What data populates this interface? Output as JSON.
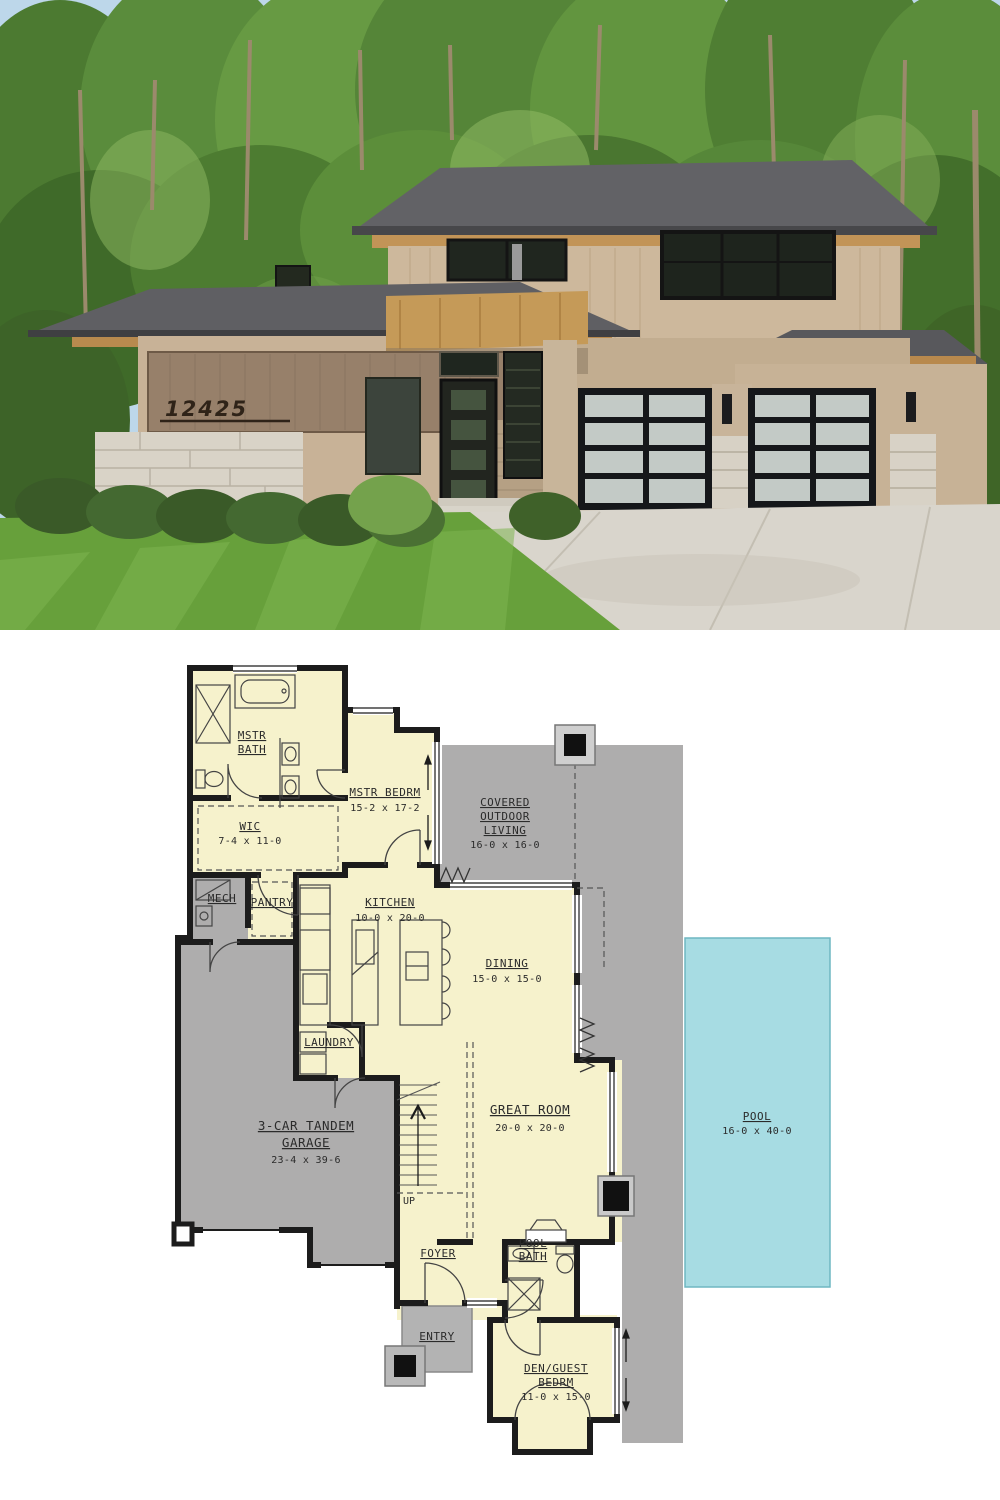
{
  "photo": {
    "house_number": "12425"
  },
  "plan": {
    "colors": {
      "room_fill": "#f6f2cc",
      "outdoor_gray": "#aeadad",
      "pool_blue": "#a7dce3",
      "wall": "#1c1c1c"
    },
    "rooms": {
      "mstr_bath": {
        "lines": [
          "MSTR",
          "BATH"
        ]
      },
      "wic": {
        "lines": [
          "WIC"
        ],
        "dims": "7-4 x 11-0"
      },
      "mstr_bedrm": {
        "lines": [
          "MSTR BEDRM"
        ],
        "dims": "15-2 x 17-2"
      },
      "covered_outdoor_living": {
        "lines": [
          "COVERED",
          "OUTDOOR",
          "LIVING"
        ],
        "dims": "16-0 x 16-0"
      },
      "mech": {
        "lines": [
          "MECH"
        ]
      },
      "pantry": {
        "lines": [
          "PANTRY"
        ]
      },
      "kitchen": {
        "lines": [
          "KITCHEN"
        ],
        "dims": "10-0 x 20-0"
      },
      "dining": {
        "lines": [
          "DINING"
        ],
        "dims": "15-0 x 15-0"
      },
      "laundry": {
        "lines": [
          "LAUNDRY"
        ]
      },
      "garage": {
        "lines": [
          "3-CAR TANDEM",
          "GARAGE"
        ],
        "dims": "23-4 x 39-6"
      },
      "great_room": {
        "lines": [
          "GREAT ROOM"
        ],
        "dims": "20-0 x 20-0"
      },
      "stairs": {
        "label": "UP"
      },
      "foyer": {
        "lines": [
          "FOYER"
        ]
      },
      "pool_bath": {
        "lines": [
          "POOL",
          "BATH"
        ]
      },
      "entry": {
        "lines": [
          "ENTRY"
        ]
      },
      "den_guest": {
        "lines": [
          "DEN/GUEST",
          "BEDRM"
        ],
        "dims": "11-0 x 15-0"
      },
      "pool": {
        "lines": [
          "POOL"
        ],
        "dims": "16-0 x 40-0"
      }
    }
  }
}
